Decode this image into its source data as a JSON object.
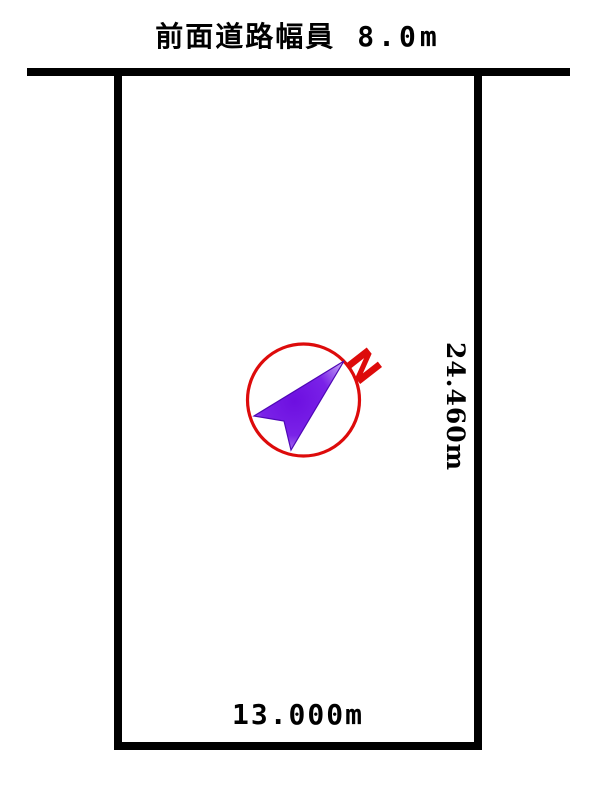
{
  "diagram": {
    "front_road_label": "前面道路幅員",
    "front_road_value": "8.0m",
    "depth_label": "24.460m",
    "frontage_label": "13.000m",
    "line_color": "#000000",
    "background_color": "#ffffff",
    "compass": {
      "north_label": "N",
      "circle_color": "#dd0b0b",
      "north_label_color": "#dd0b0b",
      "arrow_fill_center": "#6d0fe0",
      "arrow_fill_mid": "#7a22e8",
      "arrow_fill_edge": "#c9aef5",
      "arrow_outline": "#4f08b5"
    }
  }
}
